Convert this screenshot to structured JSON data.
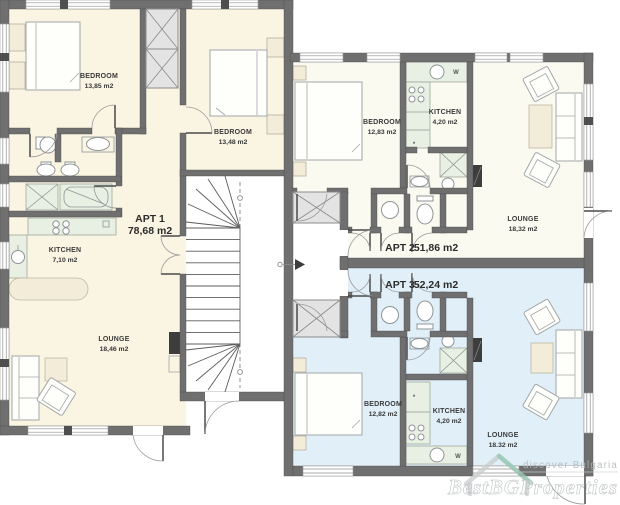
{
  "plan": {
    "apartments": [
      {
        "name": "APT 1",
        "area": "78,68 m2",
        "rooms": {
          "bedroom1": {
            "label": "BEDROOM",
            "area": "13,85 m2"
          },
          "bedroom2": {
            "label": "BEDROOM",
            "area": "13,48 m2"
          },
          "kitchen": {
            "label": "KITCHEN",
            "area": "7,10 m2"
          },
          "lounge": {
            "label": "LOUNGE",
            "area": "18,46 m2"
          }
        }
      },
      {
        "name": "APT 2",
        "area": "51,86 m2",
        "rooms": {
          "bedroom": {
            "label": "BEDROOM",
            "area": "12,83 m2"
          },
          "kitchen": {
            "label": "KITCHEN",
            "area": "4,20 m2"
          },
          "lounge": {
            "label": "LOUNGE",
            "area": "18,32 m2"
          }
        }
      },
      {
        "name": "APT 3",
        "area": "52,24 m2",
        "rooms": {
          "bedroom": {
            "label": "BEDROOM",
            "area": "12,82 m2"
          },
          "kitchen": {
            "label": "KITCHEN",
            "area": "4,20 m2"
          },
          "lounge": {
            "label": "LOUNGE",
            "area": "18.32 m2"
          }
        }
      }
    ],
    "symbols": {
      "washer": "W",
      "boiler": "*"
    },
    "watermark": {
      "tagline": "discover Bulgaria",
      "brand": "BestBGProperties"
    },
    "colors": {
      "wall": "#6f6f6f",
      "apt1_floor": "#faf4e2",
      "apt2_floor": "#fbfaf1",
      "apt3_floor": "#e1eff8",
      "counter": "#e8f0e3",
      "table": "#f2ecd8",
      "accent_teal": "#86c3a6"
    }
  }
}
